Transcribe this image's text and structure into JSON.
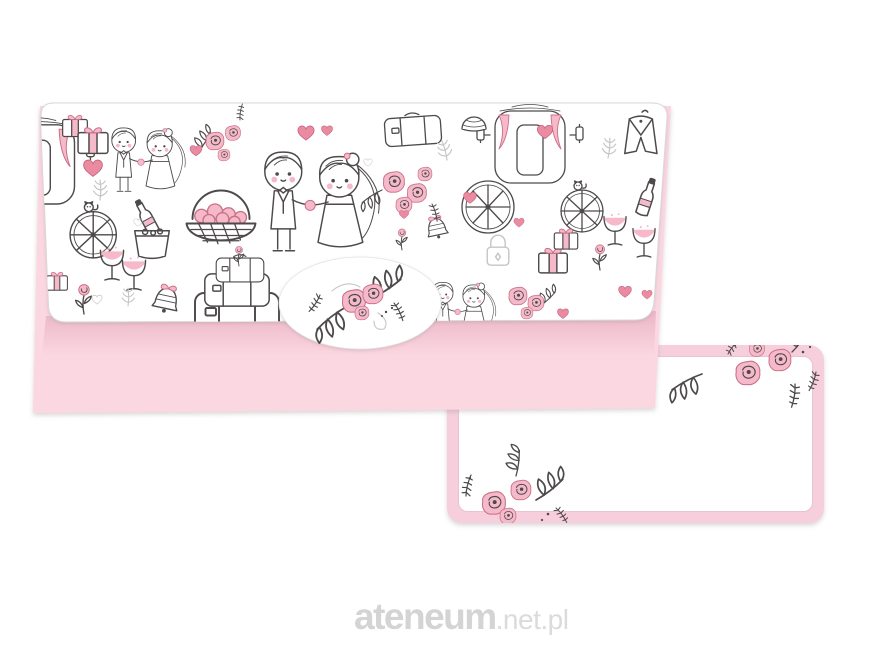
{
  "watermark": {
    "brand": "ateneum",
    "suffix": ".net.pl"
  },
  "palette": {
    "page_bg": "#ffffff",
    "envelope_pink": "#fbd7e1",
    "flap_shadow_pink": "#dd9bb2",
    "flap_edge": "#d8d8d8",
    "doodle": "#4e4a4c",
    "doodle_light": "#c6c6c6",
    "pink_fill": "#f5b9c9",
    "pink_stroke": "#c96f86",
    "heart_fill": "#ea8ba1",
    "heart_stroke": "#c2607a",
    "card_pink": "#f7cfdc",
    "card_inner_line": "#eac3d2",
    "watermark_brand": "#d4d4d4",
    "watermark_suffix": "#dbdbdb"
  },
  "product": {
    "items": [
      {
        "name": "wedding money envelope with doodle pattern flap and floral oval seal",
        "motifs": [
          "bride-and-groom",
          "hearts",
          "roses",
          "wedding-carriage",
          "champagne-bucket",
          "champagne-glasses",
          "flower-basket",
          "gift-boxes",
          "suitcases",
          "bells",
          "flowers",
          "padlock",
          "groom-suit"
        ]
      },
      {
        "name": "blank insert card with pink border and rose corner sprays",
        "motifs": [
          "rose-spray-top-right",
          "rose-spray-bottom-left"
        ]
      }
    ]
  }
}
